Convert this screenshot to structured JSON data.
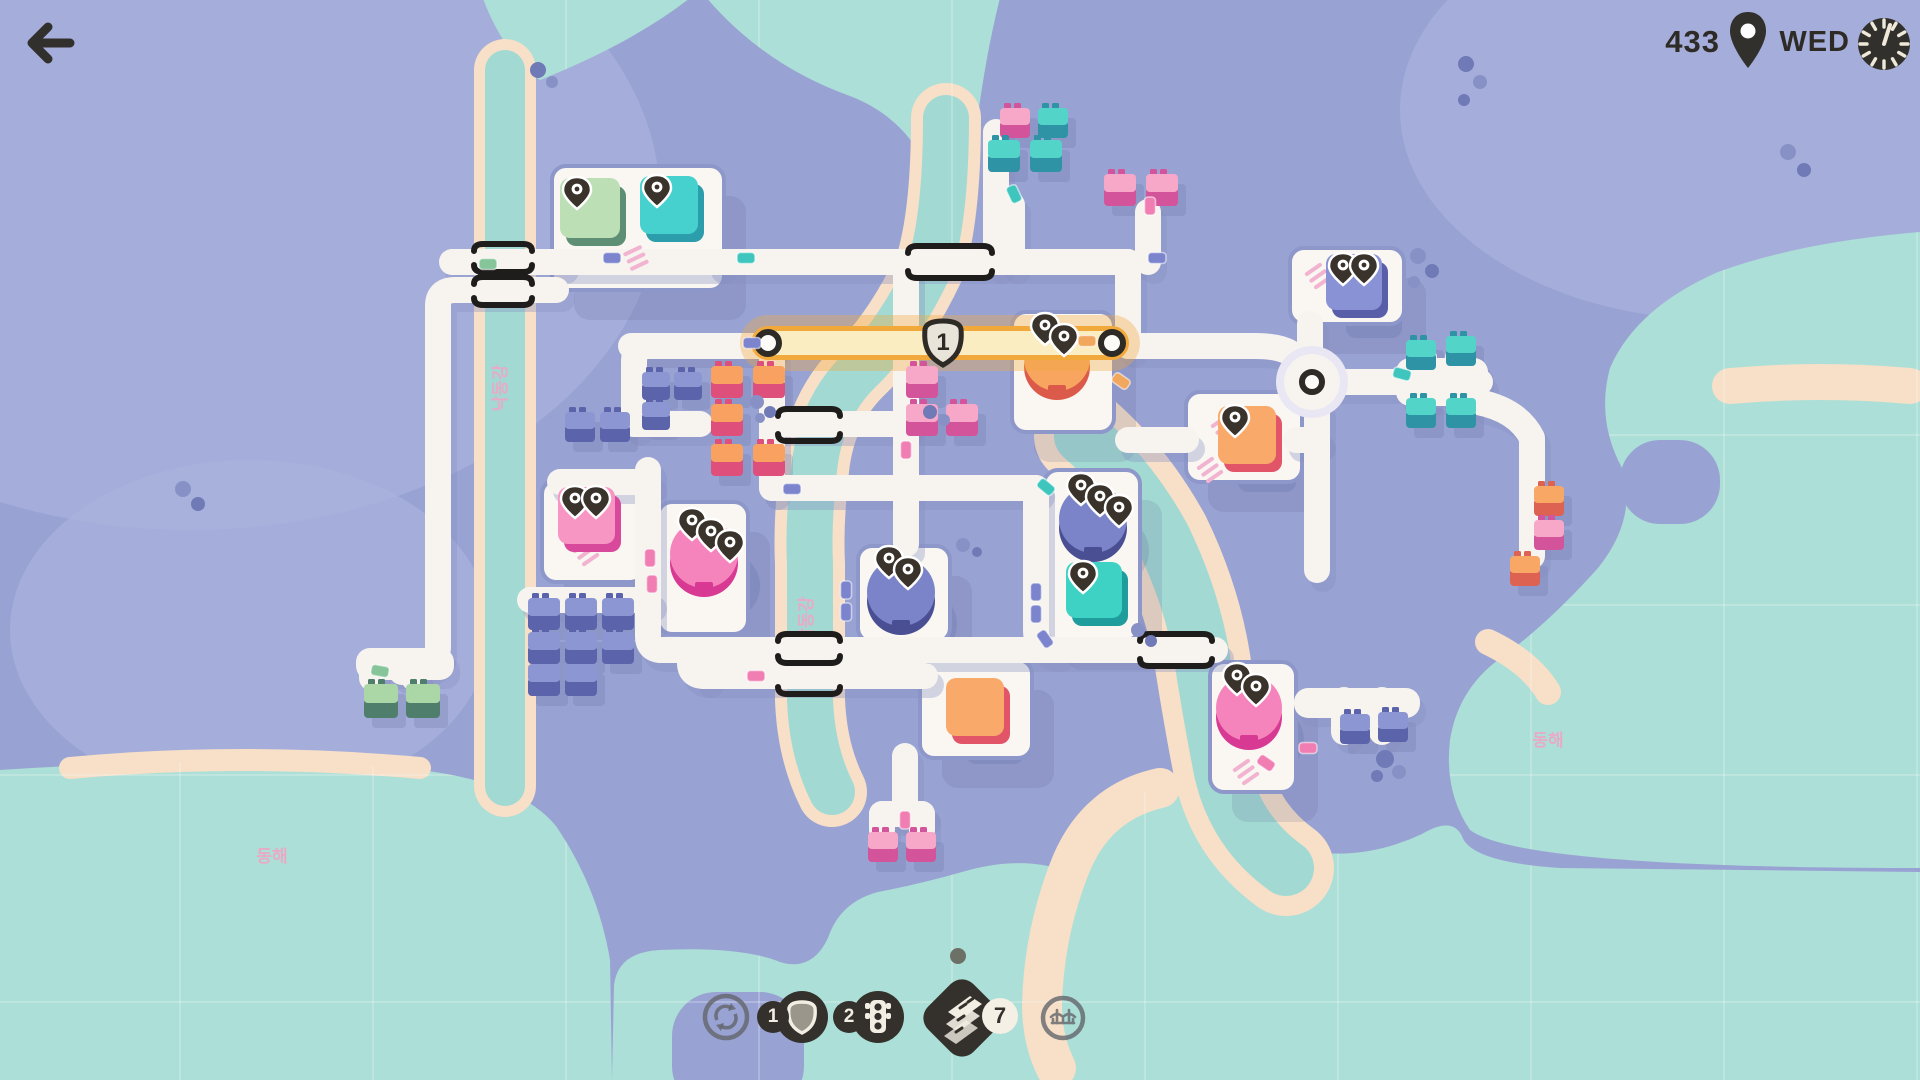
{
  "header": {
    "score": "433",
    "day": "WED"
  },
  "toolbar": {
    "roundabout_count": "",
    "motorway_badge": "1",
    "traffic_light_badge": "2",
    "road_tiles_badge": "7"
  },
  "map": {
    "palette": {
      "base": "#99A3D3",
      "lake": "#A9B2DC",
      "sea": "#ACDFD7",
      "river": "#A2DAD3",
      "beach": "#F7DFC8",
      "road": "#F7F3EF",
      "roadShadow": "#8890C0",
      "lotFill": "#FAF7F3",
      "lotEdge": "#8D97C9",
      "dark": "#32302C",
      "shadow": "#55608F",
      "label": "#F2A3C5",
      "hatch": "#F2B3D0",
      "motorwayEdge": "#F2A93C",
      "motorwayFill": "#FBEDC2",
      "shieldFill": "#E9E4DA"
    },
    "houseColors": {
      "pink": {
        "roof": "#F7A8C8",
        "wall": "#D4549C"
      },
      "teal": {
        "roof": "#52D5C8",
        "wall": "#2E93A4"
      },
      "purple": {
        "roof": "#8C96D2",
        "wall": "#5B63AA"
      },
      "green": {
        "roof": "#ABD7A6",
        "wall": "#507E6D"
      },
      "coral": {
        "roof": "#F8A160",
        "wall": "#DE4F7B"
      },
      "orange": {
        "roof": "#F8A764",
        "wall": "#DD6252"
      }
    },
    "destColors": {
      "greenSq": {
        "main": "#BCDFB6",
        "edge": "#5E8F74"
      },
      "tealSq": {
        "main": "#47D1CE",
        "edge": "#2C9DAA"
      },
      "tealSq2": {
        "main": "#3ED2C4",
        "edge": "#1F9C9C"
      },
      "purpleSq": {
        "main": "#8A92D6",
        "edge": "#585EA8"
      },
      "orangeSq": {
        "main": "#F9AA6A",
        "edge": "#E25568"
      },
      "pinkSq": {
        "main": "#F795C3",
        "edge": "#D8489B"
      },
      "pinkCirc": {
        "main": "#F584BC",
        "edge": "#D83A93"
      },
      "purpleCirc": {
        "main": "#7B83C9",
        "edge": "#4A4F94"
      },
      "orangeCirc": {
        "main": "#F8A55F",
        "edge": "#DC5A49"
      }
    },
    "carColors": {
      "green": "#86C49A",
      "teal": "#3EC6BE",
      "purple": "#7B84CC",
      "pink": "#F07EB3",
      "orange": "#F2A75F"
    },
    "lakes": [
      [
        190,
        200,
        470,
        330
      ],
      [
        1720,
        110,
        320,
        210
      ],
      [
        250,
        630,
        240,
        170
      ]
    ],
    "sea": [
      "M0 770 Q240 754 420 770 Q520 782 556 826 Q598 888 610 960 L612 1080 L0 1080 Z",
      "M612 1080 L614 985 Q618 952 660 950 Q740 946 780 962 Q812 972 828 938 Q840 902 878 892 Q920 884 962 872 Q1010 858 1048 866 Q1088 872 1102 836 Q1112 802 1146 792 Q1250 780 1248 792 Q1250 834 1302 850 Q1362 862 1422 834 Q1452 816 1462 836 Q1470 862 1560 868 L1920 872 L1920 1080 Z",
      "M1920 232 Q1800 242 1718 272 Q1636 308 1610 368 Q1596 420 1622 468 Q1638 518 1598 568 Q1548 624 1498 660 Q1458 690 1450 740 Q1444 792 1470 830 Q1520 868 1920 868 Z",
      "M700 -10 Q760 64 850 96 Q928 126 942 220 L942 250 L968 250 L968 220 Q976 90 1002 -10 Z",
      "M480 -10 H700 Q640 40 540 80 Q500 50 480 -10 Z"
    ],
    "landPatches": [
      [
        1392,
        336,
        112,
        116,
        30
      ],
      [
        672,
        992,
        132,
        118,
        44
      ],
      [
        1620,
        440,
        100,
        84,
        40
      ]
    ],
    "rivers": [
      {
        "d": "M505 70 V786",
        "w": 40,
        "bw": 62
      },
      {
        "d": "M946 118 Q946 214 930 266 Q898 334 858 372 Q820 410 814 470 Q808 524 810 564 L810 700 Q812 752 832 792",
        "w": 46,
        "bw": 70
      },
      {
        "d": "M1082 436 Q1130 478 1163 538 Q1192 598 1202 658 Q1212 722 1222 772 Q1236 832 1286 868",
        "w": 56,
        "bw": 96
      }
    ],
    "beaches": [
      {
        "d": "M70 768 Q240 752 420 768",
        "w": 22
      },
      {
        "d": "M1160 788 Q1098 802 1072 862 Q1044 930 1042 1004 Q1042 1040 1056 1068",
        "w": 40
      },
      {
        "d": "M1204 796 Q1244 838 1300 850",
        "w": 26
      },
      {
        "d": "M1488 642 Q1530 662 1548 692",
        "w": 26
      },
      {
        "d": "M1730 386 Q1820 378 1910 386",
        "w": 36
      }
    ],
    "gridV": [
      180,
      373,
      566,
      759,
      952,
      1145,
      1338,
      1531,
      1724,
      1917
    ],
    "gridH": [
      435,
      605,
      775,
      1002
    ],
    "labels": [
      {
        "t": "동해",
        "x": 272,
        "y": 862,
        "r": 0
      },
      {
        "t": "동해",
        "x": 1548,
        "y": 746,
        "r": 0
      },
      {
        "t": "낙동강",
        "x": 506,
        "y": 388,
        "r": -90
      },
      {
        "t": "낙동강",
        "x": 812,
        "y": 620,
        "r": -90
      }
    ],
    "lots": [
      [
        552,
        166,
        172,
        124
      ],
      [
        1290,
        248,
        114,
        76
      ],
      [
        1012,
        312,
        102,
        120
      ],
      [
        1186,
        392,
        116,
        90
      ],
      [
        542,
        480,
        102,
        102
      ],
      [
        658,
        502,
        90,
        132
      ],
      [
        858,
        546,
        92,
        96
      ],
      [
        1044,
        470,
        96,
        170
      ],
      [
        920,
        660,
        112,
        98
      ],
      [
        1210,
        662,
        86,
        130
      ]
    ],
    "roadBlobs": [
      [
        1396,
        358,
        92,
        48
      ],
      [
        1294,
        688,
        126,
        30
      ],
      [
        356,
        648,
        98,
        32
      ]
    ],
    "roads": [
      "M452 262 H560",
      "M556 262 H718",
      "M718 262 H1128",
      "M996 262 V132",
      "M1012 262 V205",
      "M1148 262 V212",
      "M1128 262 V346",
      "M1128 346 H1256 Q1290 346 1300 362 L1312 380",
      "M631 346 H770",
      "M770 346 H648 Q634 346 634 362 V424",
      "M556 290 H455 Q438 290 438 306 V646 Q438 664 420 664 H414 Q402 664 402 672",
      "M372 664 V678",
      "M414 664 V678",
      "M772 354 V488",
      "M634 424 H700",
      "M560 482 H648",
      "M648 470 V636",
      "M530 600 H648",
      "M648 636 Q648 650 662 650 H1215",
      "M705 676 H925",
      "M705 676 Q690 676 690 663 Q690 650 703 650",
      "M772 424 H906",
      "M906 262 V544",
      "M772 488 H1036",
      "M1036 488 V630 Q1036 650 1056 650",
      "M1317 408 V440",
      "M1128 440 H1186",
      "M1296 440 H1317",
      "M1317 440 V570",
      "M1310 358 V324",
      "M1336 382 H1480",
      "M1424 384 V358",
      "M1458 384 V358",
      "M1424 384 V398",
      "M1458 384 V398",
      "M1478 402 Q1518 410 1532 438 V556",
      "M882 814 H922",
      "M905 756 V814",
      "M882 814 V830",
      "M922 814 V830",
      "M1344 700 V732",
      "M1382 700 V732"
    ],
    "bridges": [
      {
        "x1": 474,
        "x2": 532,
        "y": 244,
        "hook": "down"
      },
      {
        "x1": 474,
        "x2": 532,
        "y": 272,
        "hook": "up"
      },
      {
        "x1": 474,
        "x2": 532,
        "y": 277,
        "hook": "down"
      },
      {
        "x1": 474,
        "x2": 532,
        "y": 305,
        "hook": "up"
      },
      {
        "x1": 908,
        "x2": 992,
        "y": 246,
        "hook": "down"
      },
      {
        "x1": 908,
        "x2": 992,
        "y": 278,
        "hook": "up"
      },
      {
        "x1": 778,
        "x2": 840,
        "y": 409,
        "hook": "down"
      },
      {
        "x1": 778,
        "x2": 840,
        "y": 441,
        "hook": "up"
      },
      {
        "x1": 778,
        "x2": 840,
        "y": 634,
        "hook": "down"
      },
      {
        "x1": 778,
        "x2": 840,
        "y": 663,
        "hook": "up"
      },
      {
        "x1": 778,
        "x2": 840,
        "y": 694,
        "hook": "up"
      },
      {
        "x1": 1140,
        "x2": 1212,
        "y": 634,
        "hook": "down"
      },
      {
        "x1": 1140,
        "x2": 1212,
        "y": 666,
        "hook": "up"
      }
    ],
    "motorway": {
      "x1": 768,
      "y1": 343,
      "x2": 1112,
      "y2": 343,
      "number": "1",
      "shieldX": 943,
      "shieldY": 343
    },
    "roundabout": {
      "cx": 1312,
      "cy": 382
    },
    "destinations": [
      {
        "kind": "square",
        "x": 560,
        "y": 178,
        "s": 60,
        "c": "greenSq",
        "pins": 1
      },
      {
        "kind": "square",
        "x": 640,
        "y": 176,
        "s": 58,
        "c": "tealSq",
        "pins": 1
      },
      {
        "kind": "square",
        "x": 1326,
        "y": 254,
        "s": 56,
        "c": "purpleSq",
        "pins": 2
      },
      {
        "kind": "circle",
        "cx": 1057,
        "cy": 360,
        "r": 33,
        "c": "orangeCirc",
        "pins": 2,
        "under": true
      },
      {
        "kind": "square",
        "x": 1218,
        "y": 406,
        "s": 58,
        "c": "orangeSq",
        "pins": 1
      },
      {
        "kind": "square",
        "x": 558,
        "y": 487,
        "s": 57,
        "c": "pinkSq",
        "pins": 2
      },
      {
        "kind": "circle",
        "cx": 704,
        "cy": 556,
        "r": 34,
        "c": "pinkCirc",
        "pins": 3
      },
      {
        "kind": "circle",
        "cx": 901,
        "cy": 594,
        "r": 34,
        "c": "purpleCirc",
        "pins": 2
      },
      {
        "kind": "circle",
        "cx": 1093,
        "cy": 521,
        "r": 34,
        "c": "purpleCirc",
        "pins": 3
      },
      {
        "kind": "square",
        "x": 1066,
        "y": 562,
        "s": 56,
        "c": "tealSq2",
        "pins": 1
      },
      {
        "kind": "square",
        "x": 946,
        "y": 678,
        "s": 58,
        "c": "orangeSq",
        "pins": 0
      },
      {
        "kind": "circle",
        "cx": 1249,
        "cy": 710,
        "r": 33,
        "c": "pinkCirc",
        "pins": 2
      }
    ],
    "houses": [
      {
        "x": 1000,
        "y": 108,
        "c": "pink",
        "s": 30
      },
      {
        "x": 1038,
        "y": 108,
        "c": "teal",
        "s": 30
      },
      {
        "x": 988,
        "y": 140,
        "c": "teal",
        "s": 32
      },
      {
        "x": 1030,
        "y": 140,
        "c": "teal",
        "s": 32
      },
      {
        "x": 1104,
        "y": 174,
        "c": "pink",
        "s": 32
      },
      {
        "x": 1146,
        "y": 174,
        "c": "pink",
        "s": 32
      },
      {
        "x": 711,
        "y": 366,
        "c": "coral",
        "s": 32
      },
      {
        "x": 753,
        "y": 366,
        "c": "coral",
        "s": 32
      },
      {
        "x": 711,
        "y": 404,
        "c": "coral",
        "s": 32
      },
      {
        "x": 711,
        "y": 444,
        "c": "coral",
        "s": 32
      },
      {
        "x": 753,
        "y": 444,
        "c": "coral",
        "s": 32
      },
      {
        "x": 642,
        "y": 372,
        "c": "purple",
        "s": 28
      },
      {
        "x": 674,
        "y": 372,
        "c": "purple",
        "s": 28
      },
      {
        "x": 642,
        "y": 402,
        "c": "purple",
        "s": 28
      },
      {
        "x": 565,
        "y": 412,
        "c": "purple",
        "s": 30
      },
      {
        "x": 600,
        "y": 412,
        "c": "purple",
        "s": 30
      },
      {
        "x": 906,
        "y": 366,
        "c": "pink",
        "s": 32
      },
      {
        "x": 906,
        "y": 404,
        "c": "pink",
        "s": 32
      },
      {
        "x": 946,
        "y": 404,
        "c": "pink",
        "s": 32
      },
      {
        "x": 528,
        "y": 598,
        "c": "purple",
        "s": 32
      },
      {
        "x": 565,
        "y": 598,
        "c": "purple",
        "s": 32
      },
      {
        "x": 602,
        "y": 598,
        "c": "purple",
        "s": 32
      },
      {
        "x": 528,
        "y": 632,
        "c": "purple",
        "s": 32
      },
      {
        "x": 565,
        "y": 632,
        "c": "purple",
        "s": 32
      },
      {
        "x": 602,
        "y": 632,
        "c": "purple",
        "s": 32
      },
      {
        "x": 528,
        "y": 664,
        "c": "purple",
        "s": 32
      },
      {
        "x": 565,
        "y": 664,
        "c": "purple",
        "s": 32
      },
      {
        "x": 364,
        "y": 684,
        "c": "green",
        "s": 34
      },
      {
        "x": 406,
        "y": 684,
        "c": "green",
        "s": 34
      },
      {
        "x": 1406,
        "y": 340,
        "c": "teal",
        "s": 30
      },
      {
        "x": 1446,
        "y": 336,
        "c": "teal",
        "s": 30
      },
      {
        "x": 1406,
        "y": 398,
        "c": "teal",
        "s": 30
      },
      {
        "x": 1446,
        "y": 398,
        "c": "teal",
        "s": 30
      },
      {
        "x": 1534,
        "y": 486,
        "c": "orange",
        "s": 30
      },
      {
        "x": 1534,
        "y": 520,
        "c": "pink",
        "s": 30
      },
      {
        "x": 1510,
        "y": 556,
        "c": "orange",
        "s": 30
      },
      {
        "x": 1340,
        "y": 714,
        "c": "purple",
        "s": 30
      },
      {
        "x": 1378,
        "y": 712,
        "c": "purple",
        "s": 30
      },
      {
        "x": 868,
        "y": 832,
        "c": "pink",
        "s": 30
      },
      {
        "x": 906,
        "y": 832,
        "c": "pink",
        "s": 30
      }
    ],
    "cars": [
      [
        488,
        264,
        0,
        "green"
      ],
      [
        612,
        258,
        0,
        "purple"
      ],
      [
        746,
        258,
        0,
        "teal"
      ],
      [
        1157,
        258,
        0,
        "purple"
      ],
      [
        752,
        343,
        0,
        "purple"
      ],
      [
        1087,
        341,
        0,
        "orange"
      ],
      [
        1121,
        381,
        35,
        "orange"
      ],
      [
        1014,
        194,
        65,
        "teal"
      ],
      [
        1150,
        206,
        90,
        "pink"
      ],
      [
        906,
        450,
        90,
        "pink"
      ],
      [
        846,
        590,
        90,
        "purple"
      ],
      [
        846,
        612,
        90,
        "purple"
      ],
      [
        1036,
        592,
        90,
        "purple"
      ],
      [
        1036,
        614,
        90,
        "purple"
      ],
      [
        1045,
        639,
        55,
        "purple"
      ],
      [
        1046,
        487,
        40,
        "teal"
      ],
      [
        650,
        558,
        90,
        "pink"
      ],
      [
        652,
        584,
        90,
        "pink"
      ],
      [
        380,
        671,
        10,
        "green"
      ],
      [
        1266,
        763,
        35,
        "pink"
      ],
      [
        1308,
        748,
        0,
        "pink"
      ],
      [
        1402,
        374,
        15,
        "teal"
      ],
      [
        905,
        820,
        90,
        "pink"
      ],
      [
        792,
        489,
        0,
        "purple"
      ],
      [
        756,
        676,
        0,
        "pink"
      ]
    ],
    "trees": [
      [
        538,
        70,
        8
      ],
      [
        552,
        82,
        6
      ],
      [
        1466,
        64,
        8
      ],
      [
        1480,
        82,
        7
      ],
      [
        1464,
        100,
        6
      ],
      [
        1788,
        152,
        8
      ],
      [
        1804,
        170,
        7
      ],
      [
        183,
        489,
        8
      ],
      [
        198,
        504,
        7
      ],
      [
        1418,
        256,
        8
      ],
      [
        1432,
        271,
        7
      ],
      [
        1414,
        282,
        6
      ],
      [
        1385,
        759,
        9
      ],
      [
        1399,
        772,
        7
      ],
      [
        1377,
        776,
        6
      ],
      [
        963,
        545,
        7
      ],
      [
        977,
        552,
        5
      ],
      [
        1138,
        630,
        7
      ],
      [
        1151,
        641,
        6
      ],
      [
        757,
        402,
        7
      ],
      [
        770,
        412,
        6
      ],
      [
        760,
        418,
        5
      ],
      [
        930,
        412,
        7
      ],
      [
        944,
        420,
        6
      ]
    ],
    "hatches": [
      {
        "x": 636,
        "y": 258,
        "r": -25
      },
      {
        "x": 586,
        "y": 553,
        "r": -35
      },
      {
        "x": 1224,
        "y": 428,
        "r": -35
      },
      {
        "x": 1246,
        "y": 772,
        "r": -35
      },
      {
        "x": 1318,
        "y": 276,
        "r": -35
      },
      {
        "x": 1210,
        "y": 470,
        "r": -35
      }
    ]
  }
}
